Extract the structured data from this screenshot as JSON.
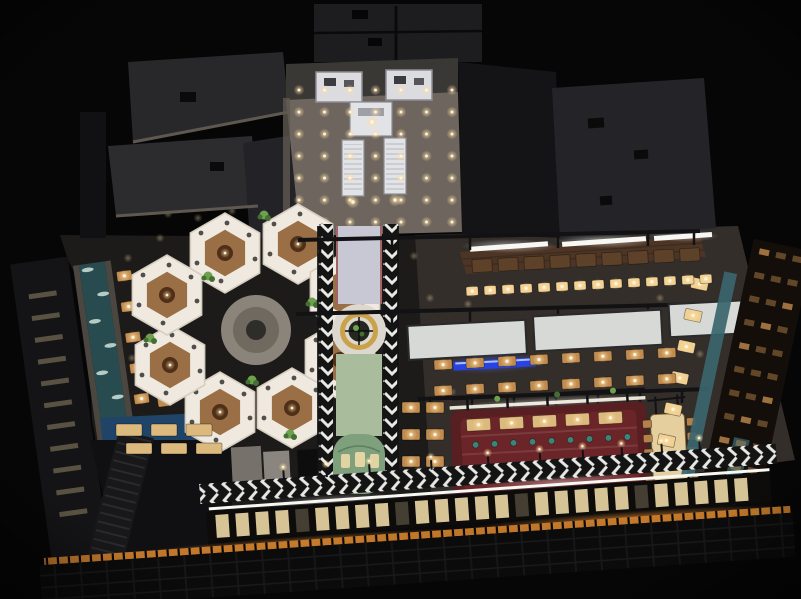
{
  "meta": {
    "description": "Night-time aerial 3D rendering of a restaurant food-hall interior: hexagonal white booth pavilions, chevron-tiled central walkway with green and grey runners, gold ring booth, red bar island, timber dining tables with glowing lamps, water channel, escalator lobby and warm-lit glass facade"
  },
  "palette": {
    "bg": "#060607",
    "roof1": "#28282b",
    "roof2": "#2c2c2f",
    "roof3": "#232327",
    "roof_right": "#242428",
    "panel_top": "#1d1d1f",
    "seam": "#0a0a0b",
    "fascia": "#5e5850",
    "wall_dark": "#141416",
    "tower": "#111113",
    "lobby_floor": "#6e665e",
    "lobby_back": "#3a3835",
    "white_struct": "#dcdce0",
    "struct_stroke": "#8d8d94",
    "esc_body": "#e2e3e7",
    "floor_dark": "#1d1b19",
    "hall_floor": "#332e2a",
    "hex_white": "#efe9df",
    "hex_stroke": "#d6cec1",
    "hex_wood": "#96683c",
    "hex_table": "#502f18",
    "hex_dot": "#35342f",
    "court": "#8a847a",
    "court_inner": "#6f695f",
    "court_table": "#2e2d2a",
    "chev_dark": "#141414",
    "chev_light": "#e8e8e5",
    "runner_grey": "#c7c8d3",
    "runner_edge": "#9c4b4b",
    "runner_green": "#a9bd9c",
    "cap_green": "#7fa07c",
    "disc": "#ddd8cf",
    "ring_gold": "#c9a24a",
    "ring_inner": "#23271f",
    "frame": "#121214",
    "canopy": "#d6d9d5",
    "canopy_stroke": "#2a2a2c",
    "led_blue": "#2743e8",
    "water": "#274b4e",
    "water_edge": "#4b463f",
    "foam": "#d8ece4",
    "blue_floor": "#1f4468",
    "island": "#581f23",
    "island_inner": "#6b2427",
    "island_light": "#f2ecdc",
    "teal": "#3f8277",
    "teal_wall": "#3a666c",
    "wood_dark": "#5d4128",
    "wood_mid": "#c08b4f",
    "wood_light": "#dcba7e",
    "wood_glow": "#f0cf92",
    "light_core": "#fff6e0",
    "canopy_wood": "#4d3526",
    "plank": "#3a2a1e",
    "striplight": "#f7f7f3",
    "facade_win": "#ecd8a6",
    "facade_orange": "#c97c2c",
    "cubby": "#d89a55",
    "stair": "#18181a",
    "stair_line": "#2a2a2d",
    "plant": "#6ea14e",
    "plant_dark": "#436f33",
    "communal": "#e6cf9e",
    "chair": "#b58049",
    "counter": "#76716a",
    "counter2": "#8a857e"
  },
  "lights": {
    "lobby_grid": {
      "x": 299,
      "y": 90,
      "dx": 25.5,
      "dy": 22,
      "cols": 7,
      "rows": 7
    },
    "extra": [
      [
        353,
        202
      ],
      [
        395,
        200
      ],
      [
        372,
        122
      ]
    ],
    "scatter": [
      [
        168,
        214
      ],
      [
        198,
        218
      ],
      [
        232,
        211
      ],
      [
        268,
        207
      ],
      [
        160,
        238
      ],
      [
        304,
        210
      ],
      [
        430,
        298
      ],
      [
        468,
        304
      ],
      [
        452,
        392
      ],
      [
        418,
        470
      ],
      [
        352,
        518
      ],
      [
        300,
        512
      ],
      [
        256,
        516
      ],
      [
        210,
        522
      ],
      [
        552,
        508
      ],
      [
        600,
        500
      ],
      [
        648,
        494
      ],
      [
        700,
        354
      ],
      [
        660,
        298
      ],
      [
        688,
        258
      ],
      [
        128,
        258
      ],
      [
        136,
        300
      ],
      [
        132,
        358
      ],
      [
        430,
        220
      ],
      [
        472,
        214
      ],
      [
        516,
        210
      ],
      [
        560,
        206
      ],
      [
        604,
        206
      ],
      [
        648,
        210
      ],
      [
        414,
        256
      ],
      [
        416,
        330
      ],
      [
        260,
        480
      ],
      [
        310,
        470
      ]
    ]
  },
  "furniture": {
    "groups": [
      {
        "n": "cabinet-row",
        "x": 472,
        "y": 254,
        "dx": 26,
        "dy": 0,
        "cols": 9,
        "rows": 1,
        "w": 20,
        "h": 13,
        "c": "wood_dark",
        "lamp": false,
        "rot": "-3 580 260"
      },
      {
        "n": "bar-tables",
        "x": 466,
        "y": 281,
        "dx": 18,
        "dy": 0,
        "cols": 14,
        "rows": 1,
        "w": 12,
        "h": 9,
        "c": "wood_glow",
        "lamp": true,
        "rot": "-3 580 285"
      },
      {
        "n": "hall-row-1",
        "x": 434,
        "y": 354,
        "dx": 32,
        "dy": 0,
        "cols": 8,
        "rows": 1,
        "w": 18,
        "h": 10,
        "c": "wood_mid",
        "lamp": true,
        "rot": "-3 550 360"
      },
      {
        "n": "hall-row-2",
        "x": 434,
        "y": 380,
        "dx": 32,
        "dy": 0,
        "cols": 8,
        "rows": 1,
        "w": 18,
        "h": 10,
        "c": "wood_mid",
        "lamp": true,
        "rot": "-3 550 385"
      },
      {
        "n": "booths-mid",
        "x": 402,
        "y": 402,
        "dx": 24,
        "dy": 27,
        "cols": 2,
        "rows": 3,
        "w": 18,
        "h": 11,
        "c": "wood_mid",
        "lamp": true
      },
      {
        "n": "island-row-top",
        "x": 468,
        "y": 415,
        "dx": 33,
        "dy": 0,
        "cols": 5,
        "rows": 1,
        "w": 24,
        "h": 12,
        "c": "wood_light",
        "lamp": true,
        "parent": "island-g"
      },
      {
        "n": "island-row-bottom",
        "x": 468,
        "y": 461,
        "dx": 33,
        "dy": 0,
        "cols": 5,
        "rows": 1,
        "w": 24,
        "h": 12,
        "c": "wood_light",
        "lamp": true,
        "parent": "island-g"
      },
      {
        "n": "right-booths",
        "x": 672,
        "y": 288,
        "dx": 0,
        "dy": 32,
        "cols": 1,
        "rows": 6,
        "w": 17,
        "h": 11,
        "c": "wood_glow",
        "lamp": true,
        "parent": "right-wall-g"
      },
      {
        "n": "water-tables-a",
        "x": 134,
        "y": 274,
        "dx": 0,
        "dy": 31,
        "cols": 1,
        "rows": 6,
        "w": 15,
        "h": 10,
        "c": "wood_mid",
        "lamp": true,
        "parent": "water-g"
      },
      {
        "n": "water-tables-b",
        "x": 157,
        "y": 280,
        "dx": 0,
        "dy": 31,
        "cols": 1,
        "rows": 5,
        "w": 14,
        "h": 10,
        "c": "wood_mid",
        "lamp": false,
        "parent": "water-g"
      },
      {
        "n": "blue-tables-1",
        "x": 116,
        "y": 424,
        "dx": 35,
        "dy": 0,
        "cols": 3,
        "rows": 1,
        "w": 26,
        "h": 12,
        "c": "wood_light",
        "lamp": false
      },
      {
        "n": "blue-tables-2",
        "x": 126,
        "y": 443,
        "dx": 35,
        "dy": 0,
        "cols": 3,
        "rows": 1,
        "w": 26,
        "h": 11,
        "c": "wood_light",
        "lamp": false
      },
      {
        "n": "communal-chairs-left",
        "x": 644,
        "y": 419,
        "dx": 0,
        "dy": 14.5,
        "cols": 1,
        "rows": 5,
        "w": 9,
        "h": 8,
        "c": "chair",
        "lamp": false,
        "parent": "communal-g"
      },
      {
        "n": "communal-chairs-right",
        "x": 688,
        "y": 419,
        "dx": 0,
        "dy": 14.5,
        "cols": 1,
        "rows": 5,
        "w": 9,
        "h": 8,
        "c": "chair",
        "lamp": false,
        "parent": "communal-g"
      }
    ],
    "island_stools": {
      "x": 476,
      "y": 441,
      "dx": 19,
      "count": 9,
      "r": 3.2
    }
  },
  "hexes": {
    "radius": 40,
    "centers": [
      [
        225,
        253
      ],
      [
        298,
        244
      ],
      [
        345,
        292
      ],
      [
        340,
        360
      ],
      [
        292,
        408
      ],
      [
        220,
        412
      ],
      [
        170,
        365
      ],
      [
        167,
        295
      ]
    ],
    "dot_offsets": [
      [
        -24,
        -20
      ],
      [
        2,
        -30
      ],
      [
        24,
        -18
      ],
      [
        30,
        6
      ],
      [
        -28,
        10
      ],
      [
        -4,
        28
      ]
    ],
    "plants": [
      [
        208,
        276
      ],
      [
        252,
        380
      ],
      [
        312,
        302
      ],
      [
        196,
        430
      ],
      [
        290,
        434
      ],
      [
        354,
        334
      ],
      [
        150,
        338
      ],
      [
        264,
        215
      ],
      [
        757,
        512
      ]
    ]
  },
  "water": {
    "foam": [
      [
        106,
        268
      ],
      [
        118,
        294
      ],
      [
        106,
        320
      ],
      [
        118,
        346
      ],
      [
        106,
        372
      ],
      [
        118,
        398
      ],
      [
        106,
        424
      ],
      [
        118,
        450
      ],
      [
        108,
        478
      ],
      [
        116,
        506
      ]
    ]
  },
  "left_wall": {
    "x": 44,
    "y": 284,
    "rows": 11,
    "dy": 22,
    "w": 28,
    "h": 5
  },
  "cubbies": {
    "x": 732,
    "y": 246,
    "cols": 3,
    "dx": 17,
    "rows": 11,
    "dy": 24,
    "w": 10,
    "h": 6
  },
  "facade": {
    "x0": 214,
    "step": 20,
    "count": 27,
    "y": 502,
    "w": 13,
    "h": 23,
    "dim": [
      4,
      9,
      15,
      21
    ],
    "lamp_xs": [
      285,
      328,
      371,
      433,
      490,
      542,
      585,
      624,
      664,
      702
    ],
    "lamp_y": 462
  }
}
